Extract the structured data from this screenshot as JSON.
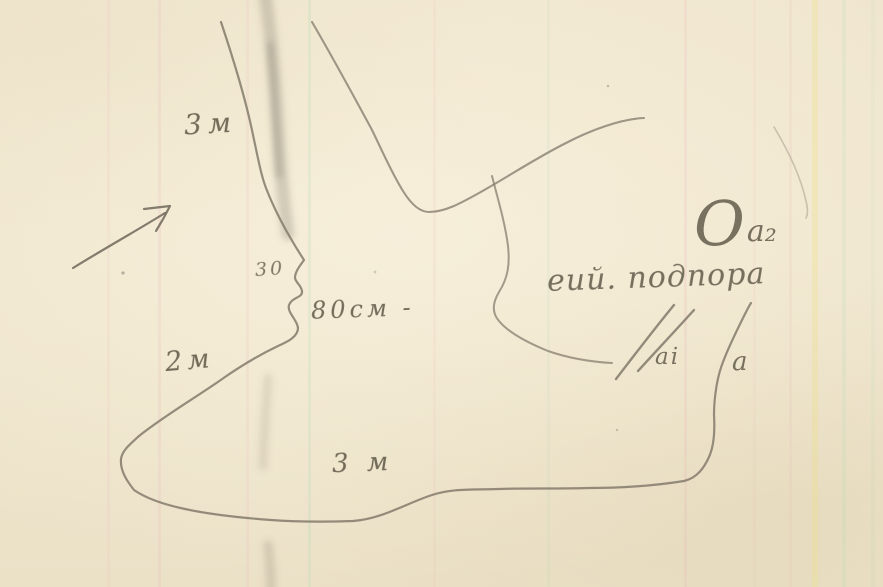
{
  "sketch": {
    "measurements": {
      "top_left": "3м",
      "notch": "30",
      "mouth": "80см -",
      "lower_left": "2м",
      "bottom": "3 м"
    },
    "points": {
      "big_o": "О",
      "a2": "а₂",
      "a1": "аi",
      "a": "а"
    },
    "note": "еий. подпора",
    "icons": {
      "direction_arrow": "arrow-up-right"
    },
    "colors": {
      "paper": "#efe5cd",
      "pencil": "#8a8173",
      "pencil_dark": "#6b6355",
      "handwriting": "#57503f",
      "stripe_pink": "#e9a9b6",
      "stripe_green": "#b9dcc0",
      "stripe_yellow": "#ece08a"
    }
  }
}
